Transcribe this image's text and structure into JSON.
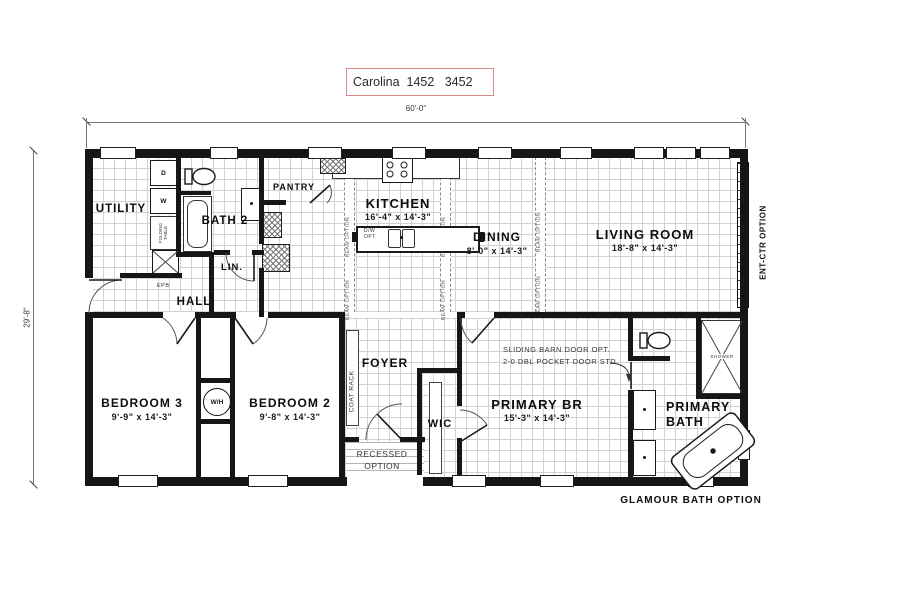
{
  "title": {
    "model": "Carolina  1452   3452"
  },
  "dimensions": {
    "width": "60'-0\"",
    "depth": "29'-8\""
  },
  "rooms": {
    "utility": {
      "name": "UTILITY"
    },
    "bath2": {
      "name": "BATH 2"
    },
    "pantry": {
      "name": "PANTRY"
    },
    "linen": {
      "name": "LIN."
    },
    "hall": {
      "name": "HALL"
    },
    "kitchen": {
      "name": "KITCHEN",
      "size": "16'-4\" x 14'-3\""
    },
    "dining": {
      "name": "DINING",
      "size": "8'-0\" x 14'-3\""
    },
    "living_room": {
      "name": "LIVING ROOM",
      "size": "18'-8\" x 14'-3\""
    },
    "bedroom3": {
      "name": "BEDROOM 3",
      "size": "9'-9\" x 14'-3\""
    },
    "bedroom2": {
      "name": "BEDROOM 2",
      "size": "9'-8\" x 14'-3\""
    },
    "foyer": {
      "name": "FOYER"
    },
    "wic": {
      "name": "WIC"
    },
    "primary_br": {
      "name": "PRIMARY BR",
      "size": "15'-3\" x 14'-3\""
    },
    "primary_bath": {
      "line1": "PRIMARY",
      "line2": "BATH"
    }
  },
  "annotations": {
    "coat_rack": "COAT RACK",
    "recessed_line1": "RECESSED",
    "recessed_line2": "OPTION",
    "barn_door_line1": "SLIDING BARN DOOR OPT.",
    "barn_door_line2": "2-0 DBL POCKET DOOR STD.",
    "glamour_bath": "GLAMOUR BATH OPTION",
    "ent_ctr": "ENT-CTR OPTION",
    "beam": "BEAM OPTION",
    "folding_table_line1": "FOLDING",
    "folding_table_line2": "TABLE",
    "epb": "EPB",
    "water_heater": "W/H",
    "dw_opt_line1": "D/W",
    "dw_opt_line2": "OPT.",
    "shower": "SHOWER",
    "dryer": "D",
    "washer": "W"
  },
  "colors": {
    "wall": "#161616",
    "floor_grid": "#d2d2d2",
    "title_border": "#d98b8b",
    "dimension_line": "#777777"
  }
}
